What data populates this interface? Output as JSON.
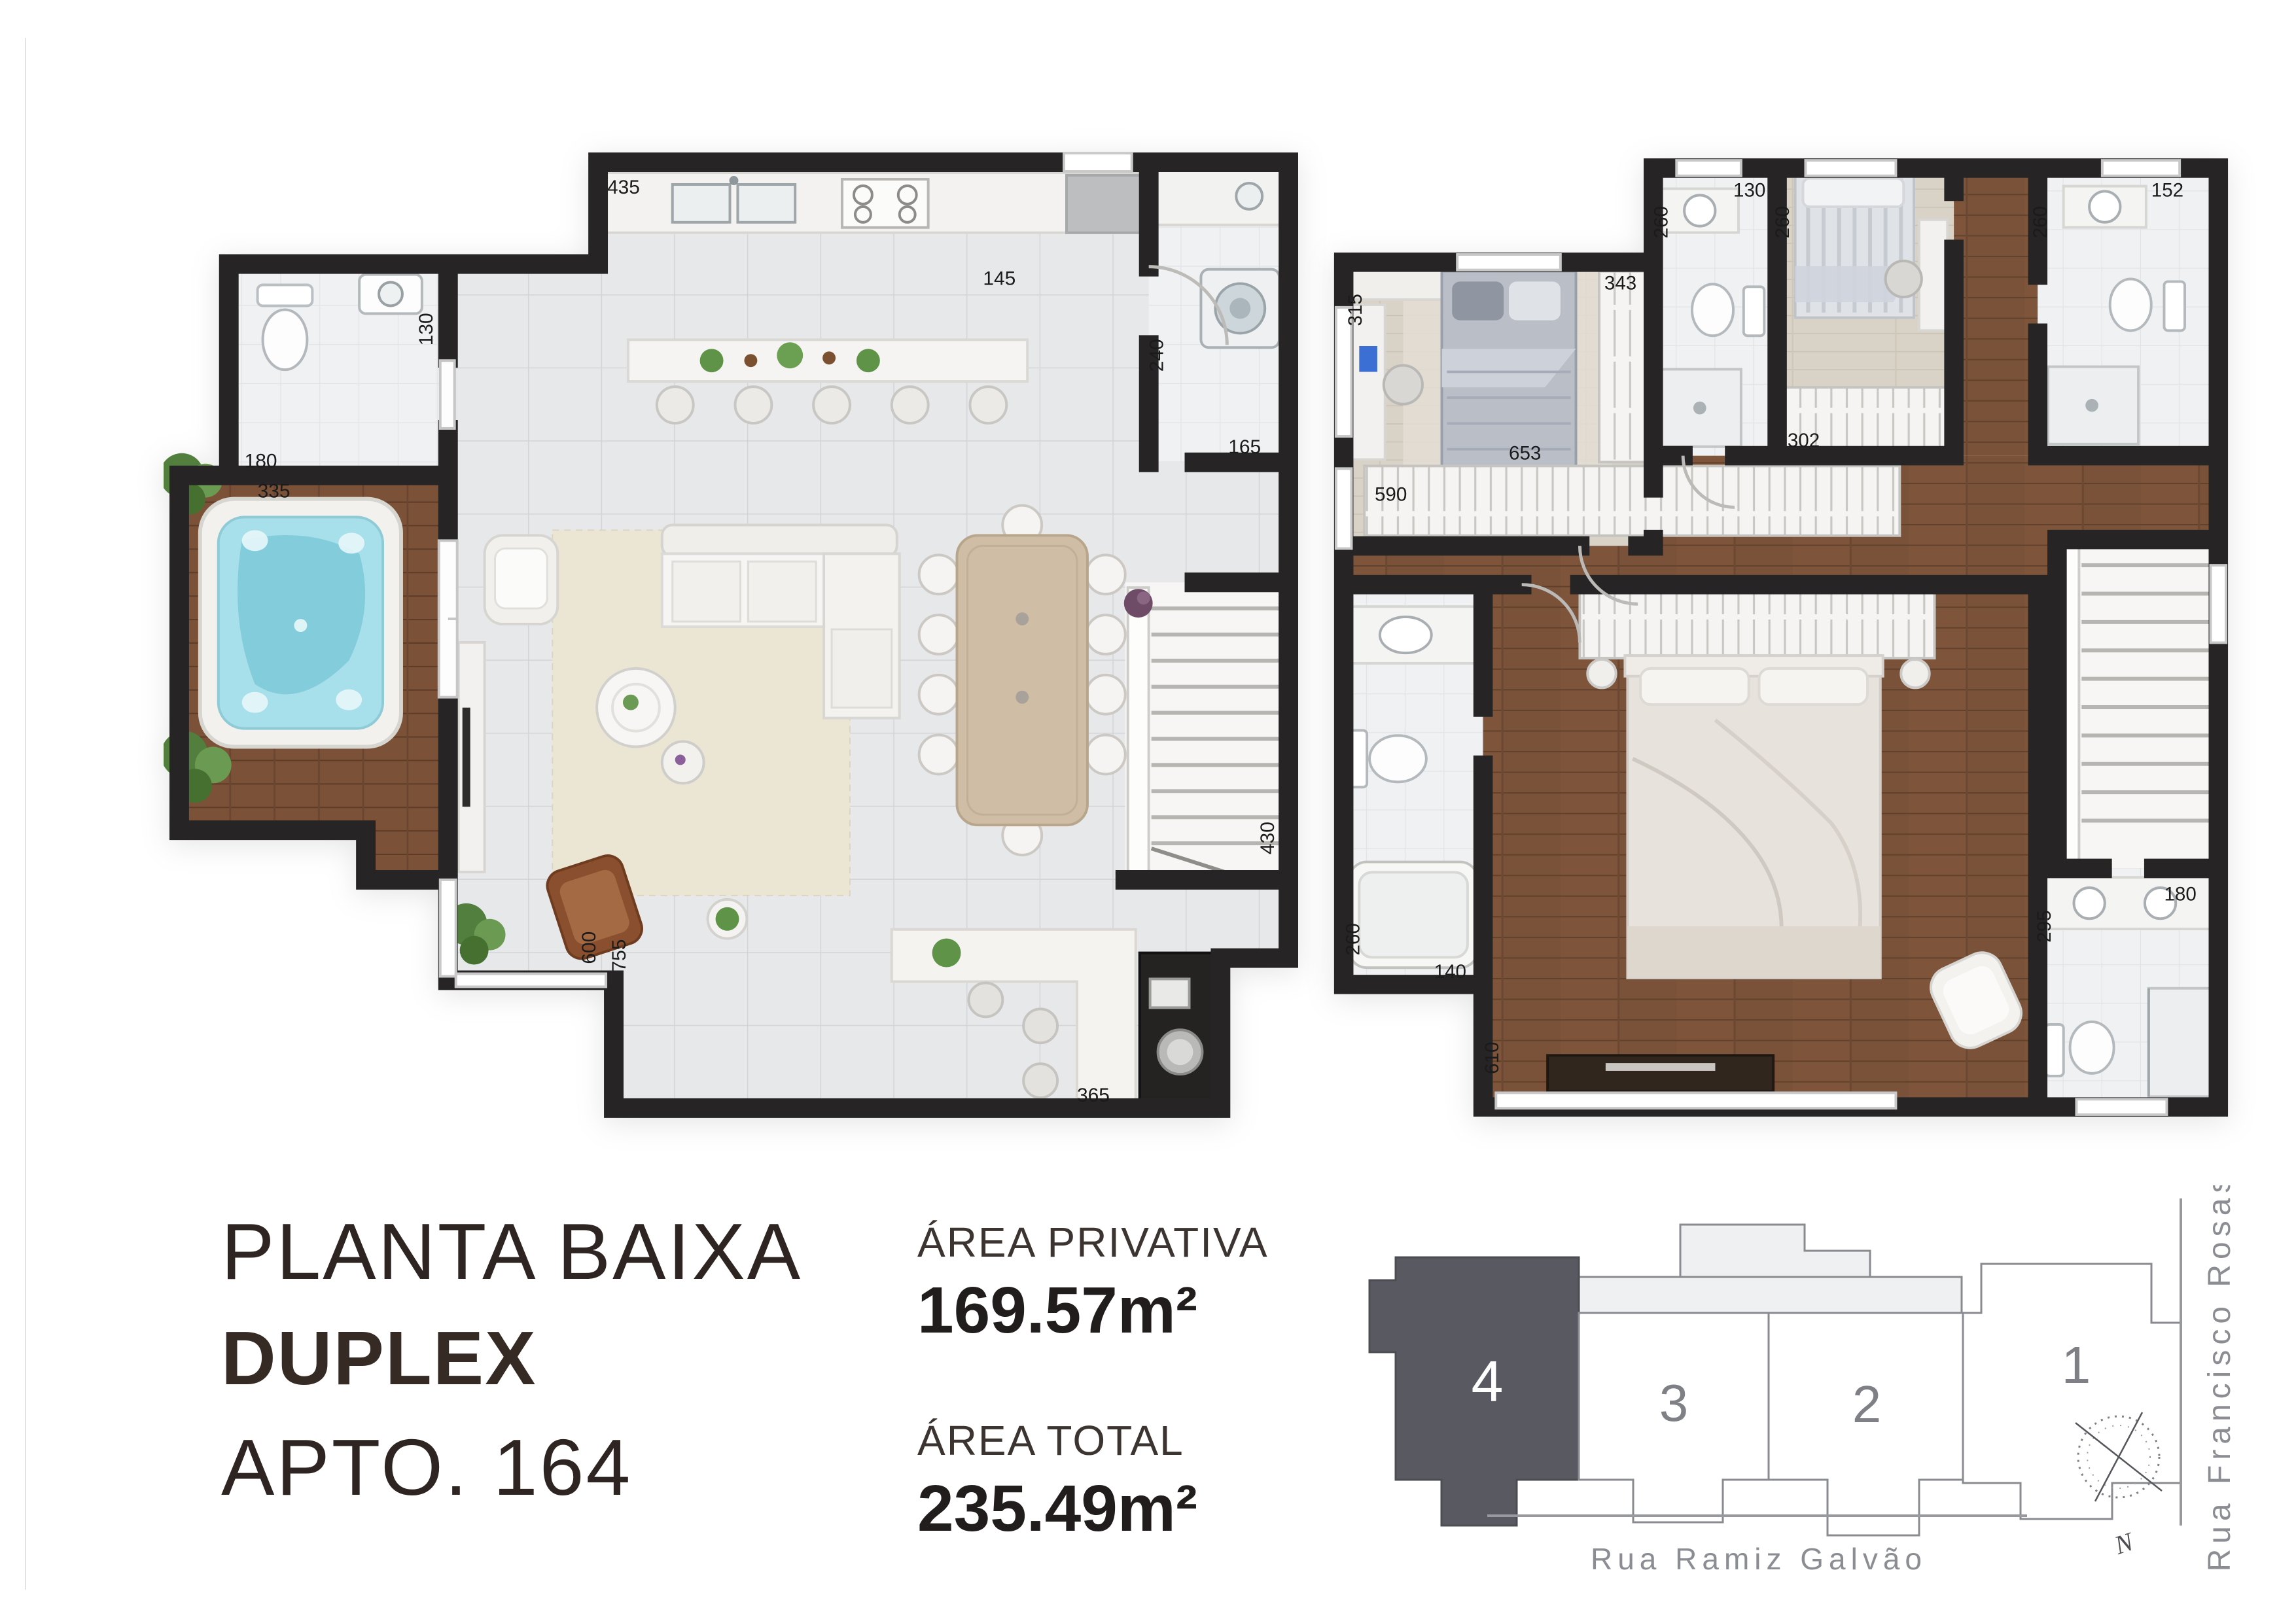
{
  "title_block": {
    "line1": "PLANTA BAIXA",
    "line2": "DUPLEX",
    "line3": "APTO. 164"
  },
  "areas": {
    "privativa_label": "ÁREA PRIVATIVA",
    "privativa_value": "169.57m²",
    "total_label": "ÁREA TOTAL",
    "total_value": "235.49m²"
  },
  "site_plan": {
    "units": [
      "4",
      "3",
      "2",
      "1"
    ],
    "highlighted_unit": "4",
    "street_bottom": "Rua Ramiz Galvão",
    "street_right": "Rua Francisco Rosas",
    "compass": "N"
  },
  "lower_floor": {
    "dims": {
      "kitchen_width": "435",
      "kitchen_counter": "145",
      "lavabo_width": "130",
      "lavabo_door": "180",
      "terrace_width": "335",
      "laundry_depth": "240",
      "laundry_width": "165",
      "living_door_a": "600",
      "living_door_b": "755",
      "stairs_length": "430",
      "bar_width": "365"
    }
  },
  "upper_floor": {
    "dims": {
      "bedroom1_width": "315",
      "bedroom1_wardrobe": "343",
      "bath1_depth": "260",
      "bath1_width": "130",
      "bedroom2_depth": "260",
      "bedroom2_closet": "302",
      "bath2_depth": "260",
      "bath2_width": "152",
      "hall_wardrobe": "590",
      "hall_length": "653",
      "masterbath_depth": "260",
      "masterbath_width": "140",
      "master_width": "610",
      "bath3_depth": "295",
      "bath3_width": "180"
    }
  },
  "colors": {
    "wall": "#262425",
    "accent_unit": "#595a61",
    "water": "#8fd6e2",
    "wood_deck": "#7b5238",
    "wood_floor": "#7a5239"
  }
}
